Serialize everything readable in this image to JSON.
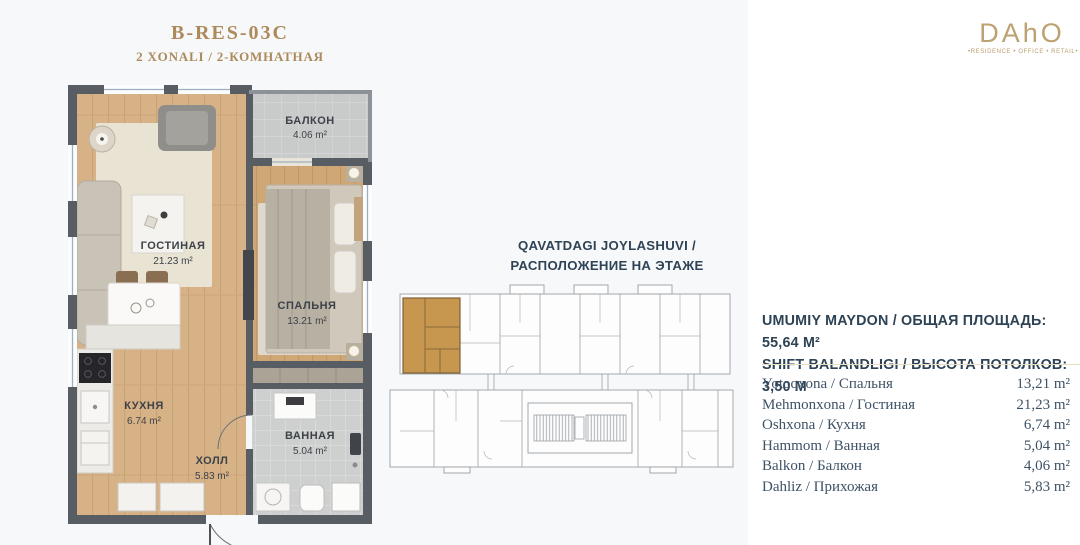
{
  "header": {
    "title": "B-RES-03C",
    "subtitle": "2 XONALI / 2-КОМНАТНАЯ"
  },
  "logo": {
    "name": "DAhO",
    "tagline": "•RESIDENCE • OFFICE • RETAIL•"
  },
  "floor_location": {
    "line1": "QAVATDAGI JOYLASHUVI /",
    "line2": "РАСПОЛОЖЕНИЕ НА ЭТАЖЕ"
  },
  "summary": {
    "line1": "UMUMIY MAYDON / ОБЩАЯ ПЛОЩАДЬ: 55,64 М²",
    "line2": "SHIFT BALANDLIGI / ВЫСОТА ПОТОЛКОВ: 3,50 М"
  },
  "rooms_table": {
    "rows": [
      {
        "label": "Yotoqxona / Спальня",
        "value": "13,21 m²"
      },
      {
        "label": "Mehmonxona / Гостиная",
        "value": "21,23 m²"
      },
      {
        "label": "Oshxona / Кухня",
        "value": "6,74 m²"
      },
      {
        "label": "Hammom / Ванная",
        "value": "5,04 m²"
      },
      {
        "label": "Balkon / Балкон",
        "value": "4,06 m²"
      },
      {
        "label": "Dahliz / Прихожая",
        "value": "5,83 m²"
      }
    ]
  },
  "plan_labels": {
    "living": {
      "name": "ГОСТИНАЯ",
      "area": "21.23 m²"
    },
    "bedroom": {
      "name": "СПАЛЬНЯ",
      "area": "13.21 m²"
    },
    "kitchen": {
      "name": "КУХНЯ",
      "area": "6.74 m²"
    },
    "bathroom": {
      "name": "ВАННАЯ",
      "area": "5.04 m²"
    },
    "hall": {
      "name": "ХОЛЛ",
      "area": "5.83 m²"
    },
    "balcony": {
      "name": "БАЛКОН",
      "area": "4.06 m²"
    }
  },
  "colors": {
    "accent_gold": "#ad8a5c",
    "text_dark": "#2d4254",
    "highlight_unit": "#c7964f",
    "wall": "#575d63"
  }
}
